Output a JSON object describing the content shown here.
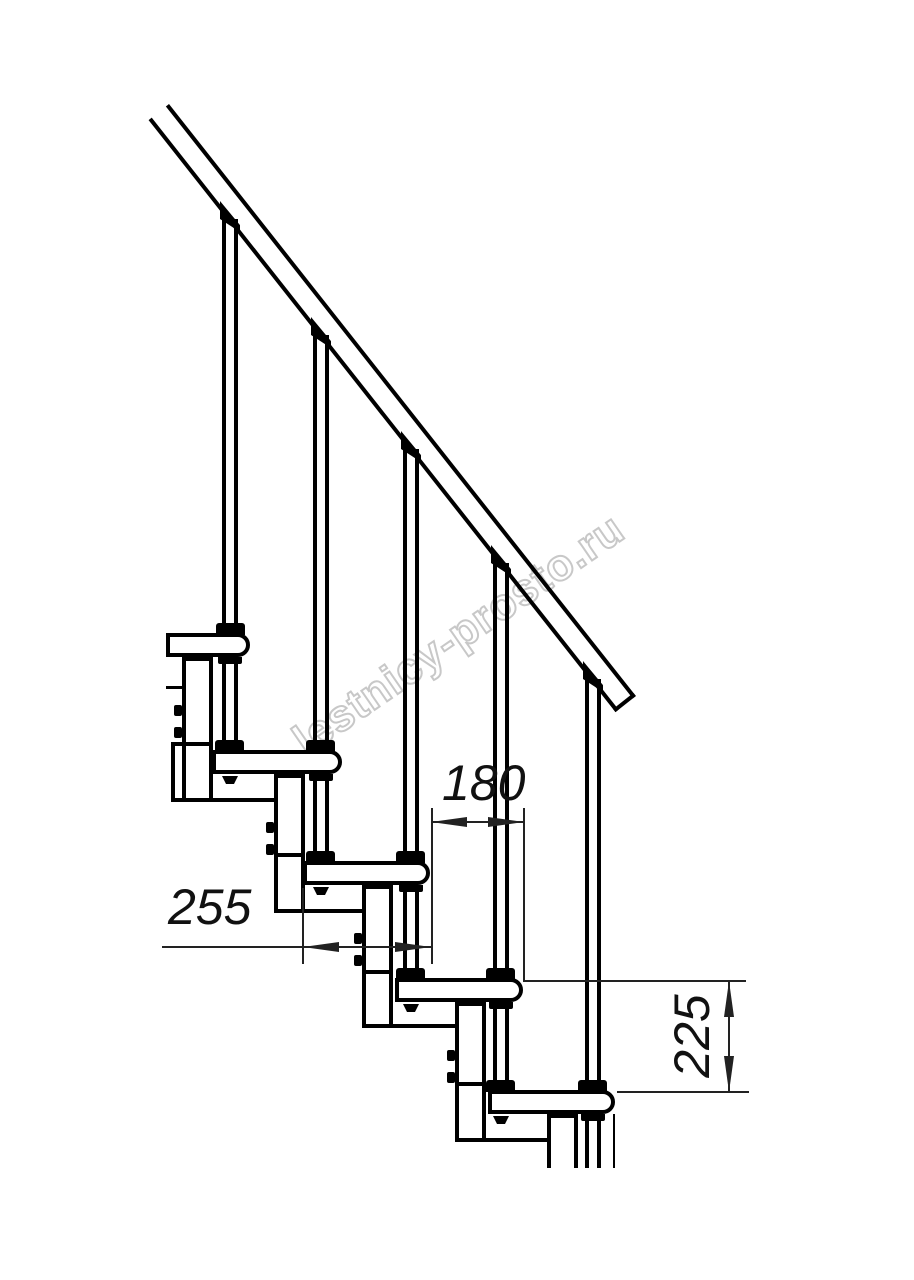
{
  "watermark": {
    "text": "lestnicy-prosto.ru",
    "color": "#c8c8c8"
  },
  "dimensions": {
    "step_run": {
      "value": "180",
      "orientation": "horizontal"
    },
    "tread_depth": {
      "value": "255",
      "orientation": "horizontal"
    },
    "step_rise": {
      "value": "225",
      "orientation": "vertical"
    }
  },
  "structure": {
    "type": "modular staircase side-view technical drawing",
    "treads_visible": 5,
    "balusters_visible": 5
  },
  "colors": {
    "background": "#ffffff",
    "line": "#000000",
    "dimension_line": "#222222"
  }
}
